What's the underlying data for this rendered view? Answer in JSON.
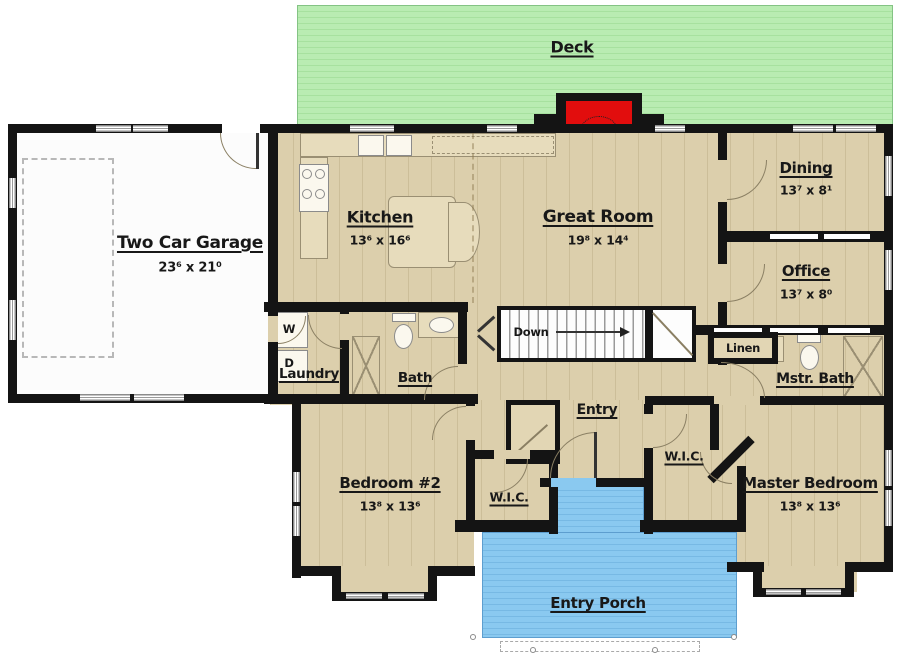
{
  "colors": {
    "floor_tan": "#dccfac",
    "deck_green": "#b9ecb2",
    "porch_blue": "#8ac9f0",
    "wall_black": "#141414",
    "fireplace_red": "#e20d0d",
    "garage_white": "#fcfcfc"
  },
  "rooms": {
    "deck": {
      "label": "Deck"
    },
    "garage": {
      "label": "Two Car Garage",
      "dims": "23⁶ x 21⁰"
    },
    "kitchen": {
      "label": "Kitchen",
      "dims": "13⁶ x 16⁶"
    },
    "great_room": {
      "label": "Great Room",
      "dims": "19⁸ x 14⁴"
    },
    "dining": {
      "label": "Dining",
      "dims": "13⁷ x 8¹"
    },
    "office": {
      "label": "Office",
      "dims": "13⁷ x 8⁰"
    },
    "laundry": {
      "label": "Laundry"
    },
    "washer": {
      "label": "W"
    },
    "dryer": {
      "label": "D"
    },
    "bath": {
      "label": "Bath"
    },
    "stairs": {
      "label": "Down"
    },
    "linen": {
      "label": "Linen"
    },
    "master_bath": {
      "label": "Mstr. Bath"
    },
    "entry": {
      "label": "Entry"
    },
    "wic_bedroom2": {
      "label": "W.I.C."
    },
    "wic_master": {
      "label": "W.I.C."
    },
    "bedroom2": {
      "label": "Bedroom #2",
      "dims": "13⁸ x 13⁶"
    },
    "master_bedroom": {
      "label": "Master Bedroom",
      "dims": "13⁸ x 13⁶"
    },
    "entry_porch": {
      "label": "Entry Porch"
    }
  }
}
